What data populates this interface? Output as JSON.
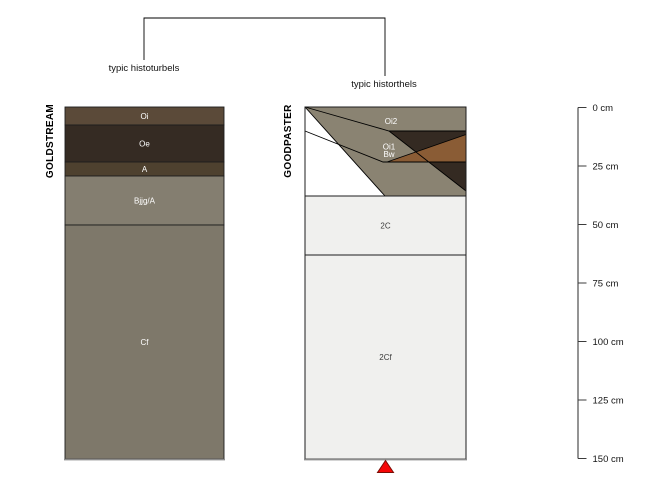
{
  "figure": {
    "kind": "soil profile comparison sketch",
    "depth_unit": "cm"
  },
  "bracket": {
    "left_label": "typic histoturbels",
    "right_label": "typic historthels"
  },
  "profiles": {
    "goldstream": {
      "name": "GOLDSTREAM",
      "subgroup": "typic histoturbels",
      "horizons": [
        {
          "label": "Oi",
          "top_cm": 0,
          "bottom_cm": 8,
          "color": "#5b4a39"
        },
        {
          "label": "Oe",
          "top_cm": 8,
          "bottom_cm": 23,
          "color": "#352b23"
        },
        {
          "label": "A",
          "top_cm": 23,
          "bottom_cm": 29,
          "color": "#4e412f"
        },
        {
          "label": "Bjjg/A",
          "top_cm": 29,
          "bottom_cm": 50,
          "color": "#847e70"
        },
        {
          "label": "Cf",
          "top_cm": 50,
          "bottom_cm": 150,
          "color": "#7e786a"
        }
      ]
    },
    "goodpaster": {
      "name": "GOODPASTER",
      "subgroup": "typic historthels",
      "horizons": [
        {
          "label": "Oi2",
          "top_cm": 0,
          "bottom_cm": 10,
          "color": "#8a8372"
        },
        {
          "label": "Oi1",
          "top_cm": 10,
          "bottom_cm": 23,
          "color": "#342a22"
        },
        {
          "label": "Bw",
          "top_cm": 23,
          "bottom_cm": 38,
          "color": "#8a5c35"
        },
        {
          "label": "2C",
          "top_cm": 38,
          "bottom_cm": 63,
          "color": "#f0f0ee"
        },
        {
          "label": "2Cf",
          "top_cm": 63,
          "bottom_cm": 150,
          "color": "#f0f0ee"
        }
      ]
    }
  },
  "depth_axis": {
    "unit": "cm",
    "ticks": [
      "0 cm",
      "25 cm",
      "50 cm",
      "75 cm",
      "100 cm",
      "125 cm",
      "150 cm"
    ]
  },
  "marker": {
    "shape": "triangle-up",
    "color": "#f60606"
  },
  "chart_data": {
    "type": "table",
    "ylim": [
      0,
      150
    ],
    "unit": "cm",
    "series": [
      {
        "name": "GOLDSTREAM",
        "subgroup": "typic histoturbels",
        "horizons": [
          [
            "Oi",
            0,
            8
          ],
          [
            "Oe",
            8,
            23
          ],
          [
            "A",
            23,
            29
          ],
          [
            "Bjjg/A",
            29,
            50
          ],
          [
            "Cf",
            50,
            150
          ]
        ]
      },
      {
        "name": "GOODPASTER",
        "subgroup": "typic historthels",
        "horizons": [
          [
            "Oi2",
            0,
            10
          ],
          [
            "Oi1",
            10,
            23
          ],
          [
            "Bw",
            23,
            38
          ],
          [
            "2C",
            38,
            63
          ],
          [
            "2Cf",
            63,
            150
          ]
        ]
      }
    ]
  }
}
